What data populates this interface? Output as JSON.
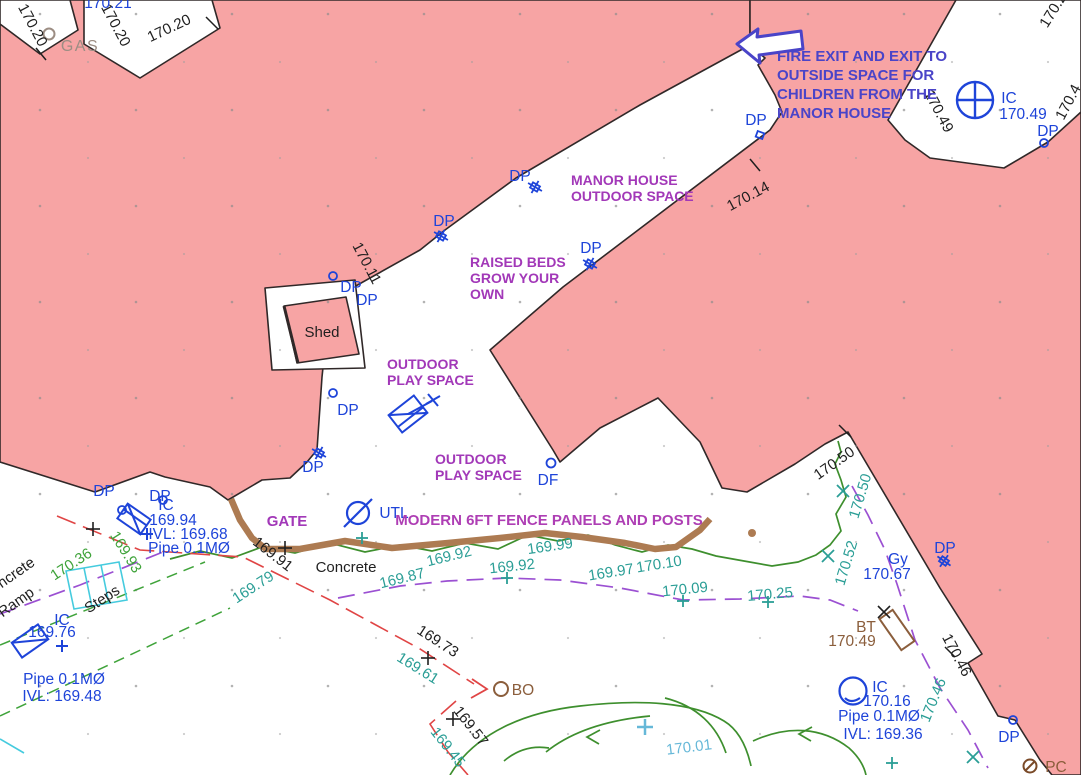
{
  "colors": {
    "building_fill": "#F7A4A4",
    "building_edge": "#302828",
    "utility_blue": "#1E44D9",
    "annotation_purple": "#A238B8",
    "fire_exit_blue": "#4A44C8",
    "level_teal": "#2B9E96",
    "level_green": "#3FA33A",
    "level_light_blue": "#66B8D8",
    "fence_brown": "#AD7B52",
    "feature_brown": "#8B5E3C",
    "survey_red": "#E04545",
    "boundary_purple_dash": "#9B50D2",
    "steps_cyan": "#45CBDE"
  },
  "annotations": {
    "fire_exit": {
      "lines": [
        "FIRE EXIT AND EXIT TO",
        "OUTSIDE SPACE FOR",
        "CHILDREN FROM THE",
        "MANOR HOUSE"
      ]
    },
    "manor_house": {
      "lines": [
        "MANOR HOUSE",
        "OUTDOOR SPACE"
      ]
    },
    "raised_beds": {
      "lines": [
        "RAISED BEDS",
        "GROW YOUR",
        "OWN"
      ]
    },
    "play_space_1": {
      "lines": [
        "OUTDOOR",
        "PLAY SPACE"
      ]
    },
    "play_space_2": {
      "lines": [
        "OUTDOOR",
        "PLAY SPACE"
      ]
    },
    "gate": "GATE",
    "fence": "MODERN 6FT FENCE PANELS AND POSTS"
  },
  "features": {
    "shed": "Shed",
    "concrete": "Concrete",
    "concrete_ramp": {
      "lines": [
        "Concrete",
        "Ramp"
      ]
    },
    "steps": "Steps",
    "gas": "GAS",
    "bo": "BO",
    "bt": {
      "label": "BT",
      "level": "170.49"
    },
    "pc": "PC"
  },
  "utilities": {
    "dp": "DP",
    "df": "DF",
    "utl": "UTL",
    "ic": "IC",
    "gy": {
      "label": "Gy",
      "level": "170.67"
    },
    "ic_top_right": {
      "label": "IC",
      "level": "170.49"
    },
    "ic_left": {
      "label": "IC",
      "level": "169.94",
      "invert": "IVL: 169.68",
      "pipe": "Pipe 0.1MØ"
    },
    "ic_bottom_left": {
      "label": "IC",
      "level": "169.76"
    },
    "pipe_bottom_left": {
      "pipe": "Pipe 0.1MØ",
      "invert": "IVL: 169.48"
    },
    "ic_bottom_right": {
      "label": "IC",
      "level": "170.16",
      "pipe": "Pipe 0.1MØ",
      "invert": "IVL: 169.36"
    }
  },
  "levels": {
    "building": [
      "170.20",
      "170.20",
      "170.20",
      "170.11",
      "170.14",
      "170.49",
      "170.4",
      "170.2",
      "170.50",
      "170.46",
      "169.91",
      "169.73",
      "169.57"
    ],
    "partial_top": "170.21",
    "ground_teal": [
      "169.79",
      "169.87",
      "169.92",
      "169.92",
      "169.99",
      "169.97",
      "170.10",
      "170.09",
      "170.25",
      "170.50",
      "170.52",
      "170.46",
      "169.61",
      "169.45"
    ],
    "ground_green": [
      "169.93",
      "170.36"
    ],
    "ground_light": [
      "170.01"
    ]
  }
}
